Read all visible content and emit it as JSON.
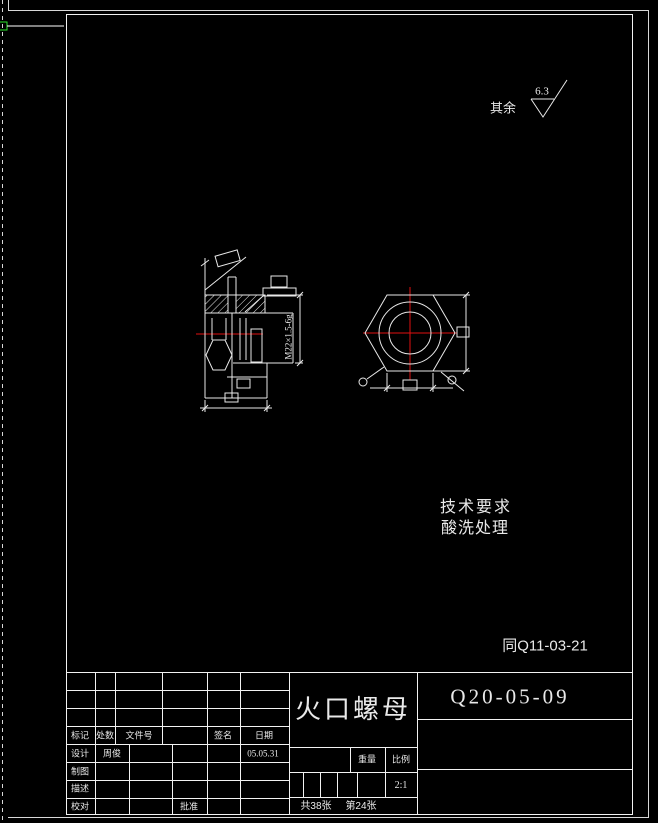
{
  "colors": {
    "background": "#000000",
    "line": "#f2f2f2",
    "centerline": "#e01010",
    "cursor_green": "#2ce52c",
    "text": "#e9e9e9"
  },
  "annotations": {
    "surface_note": "其余",
    "surface_value": "6.3",
    "tech_title": "技术要求",
    "tech_item": "酸洗处理",
    "reference": "同Q11-03-21",
    "thread_dim": "M22×1.5-6g"
  },
  "title_block": {
    "part_name": "火口螺母",
    "drawing_no": "Q20-05-09",
    "header": {
      "mark": "标记",
      "count": "处数",
      "doc_no": "文件号",
      "sign": "签名",
      "date": "日期"
    },
    "rows": [
      {
        "label": "设计",
        "value": "周俊",
        "date": "05.05.31"
      },
      {
        "label": "制图",
        "value": "",
        "date": ""
      },
      {
        "label": "描述",
        "value": "",
        "date": ""
      },
      {
        "label": "校对",
        "value": "",
        "date": ""
      }
    ],
    "approve": "批准",
    "weight_label": "重量",
    "scale_label": "比例",
    "scale_value": "2:1",
    "sheets_total": "共38张",
    "sheet_current": "第24张"
  }
}
